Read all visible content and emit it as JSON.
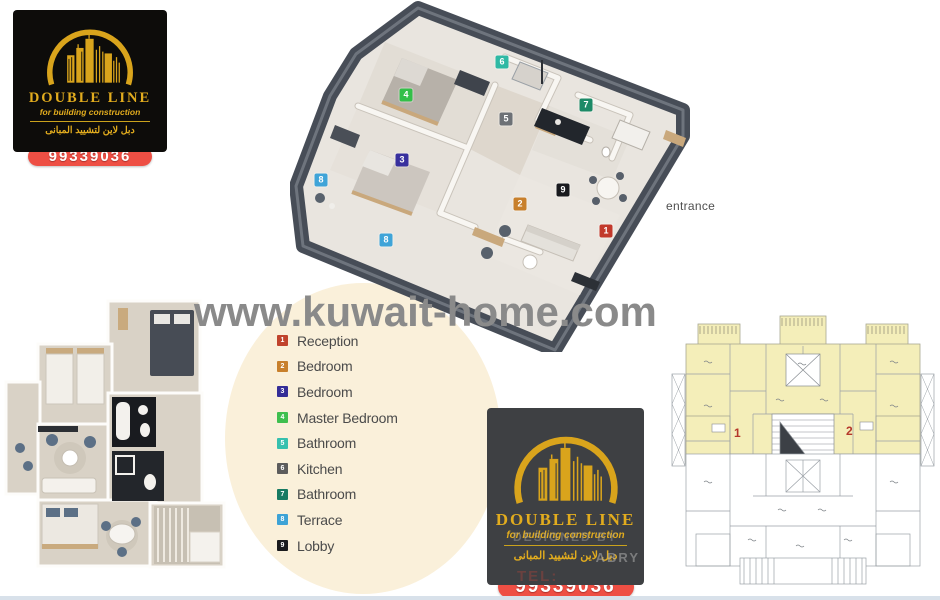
{
  "page": {
    "background": "#ffffff",
    "bottom_strip_color": "#d8e1ea"
  },
  "watermark": {
    "text": "www.kuwait-home.com",
    "color": "#8a8a8a"
  },
  "brand": {
    "name": "DOUBLE LINE",
    "tagline": "for building construction",
    "arabic": "دبل لاين لتشييد المبانى",
    "phone": "99339036",
    "gold": "#e2ac1e",
    "pill_red": "#ee4f44"
  },
  "logo_bottom_ghost": {
    "line1": "DESIGNED BY",
    "line2": "ABRY",
    "tel": "TEL: 50459622"
  },
  "plan3d": {
    "entrance_label": "entrance",
    "markers": [
      {
        "num": "1",
        "label": "Reception",
        "color": "#c2392b",
        "x": 316,
        "y": 231
      },
      {
        "num": "2",
        "label": "Bedroom",
        "color": "#c8802c",
        "x": 230,
        "y": 204
      },
      {
        "num": "3",
        "label": "Bedroom",
        "color": "#38309e",
        "x": 112,
        "y": 160
      },
      {
        "num": "4",
        "label": "Master Bedroom",
        "color": "#33bf49",
        "x": 116,
        "y": 95
      },
      {
        "num": "5",
        "label": "Kitchen",
        "color": "#6d7176",
        "x": 216,
        "y": 119
      },
      {
        "num": "6",
        "label": "Bathroom",
        "color": "#2fb9a4",
        "x": 212,
        "y": 62
      },
      {
        "num": "7",
        "label": "Bathroom",
        "color": "#1d8a67",
        "x": 296,
        "y": 105
      },
      {
        "num": "8",
        "label": "Terrace",
        "color": "#3fa4d8",
        "x": 31,
        "y": 180
      },
      {
        "num": "8",
        "label": "Terrace",
        "color": "#3fa4d8",
        "x": 96,
        "y": 240
      },
      {
        "num": "9",
        "label": "Lobby",
        "color": "#191a1e",
        "x": 273,
        "y": 190
      }
    ]
  },
  "legend": {
    "items": [
      {
        "num": "1",
        "label": "Reception",
        "color": "#c0432c"
      },
      {
        "num": "2",
        "label": "Bedroom",
        "color": "#c8802c"
      },
      {
        "num": "3",
        "label": "Bedroom",
        "color": "#342d97"
      },
      {
        "num": "4",
        "label": "Master Bedroom",
        "color": "#3fbf4f"
      },
      {
        "num": "5",
        "label": "Bathroom",
        "color": "#36c0ae"
      },
      {
        "num": "6",
        "label": "Kitchen",
        "color": "#5c5c5c"
      },
      {
        "num": "7",
        "label": "Bathroom",
        "color": "#177a62"
      },
      {
        "num": "8",
        "label": "Terrace",
        "color": "#3da3d6"
      },
      {
        "num": "9",
        "label": "Lobby",
        "color": "#1a1a1d"
      }
    ]
  },
  "plan_cad": {
    "unit1": "1",
    "unit2": "2",
    "highlight_color": "#f4eeb9",
    "unit_number_color": "#b5372a"
  }
}
